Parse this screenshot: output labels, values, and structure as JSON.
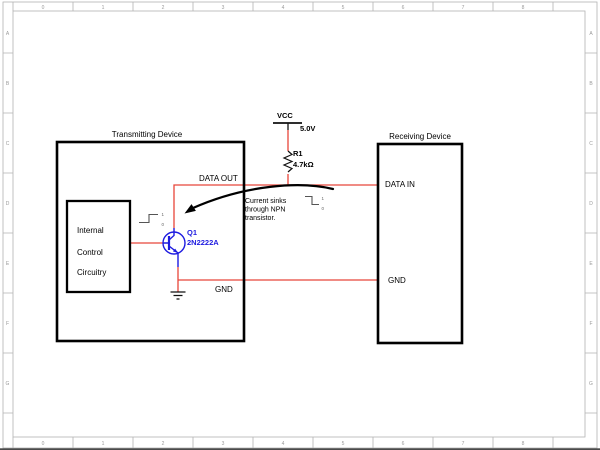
{
  "sheet": {
    "cols": [
      "0",
      "1",
      "2",
      "3",
      "4",
      "5",
      "6",
      "7",
      "8"
    ],
    "rows": [
      "A",
      "B",
      "C",
      "D",
      "E",
      "F",
      "G"
    ]
  },
  "colors": {
    "wire": "#e8463a",
    "semi": "#1d1ae0"
  },
  "tx": {
    "title": "Transmitting Device",
    "block_line1": "Internal",
    "block_line2": "Control",
    "block_line3": "Circuitry",
    "data_out": "DATA OUT",
    "gnd": "GND"
  },
  "rx": {
    "title": "Receiving Device",
    "data_in": "DATA IN",
    "gnd": "GND"
  },
  "power": {
    "net": "VCC",
    "voltage": "5.0V"
  },
  "resistor": {
    "ref": "R1",
    "value": "4.7kΩ"
  },
  "transistor": {
    "ref": "Q1",
    "part": "2N2222A"
  },
  "note": {
    "line1": "Current sinks",
    "line2": "through NPN",
    "line3": "transistor."
  },
  "logic": {
    "high": "1",
    "low": "0"
  }
}
